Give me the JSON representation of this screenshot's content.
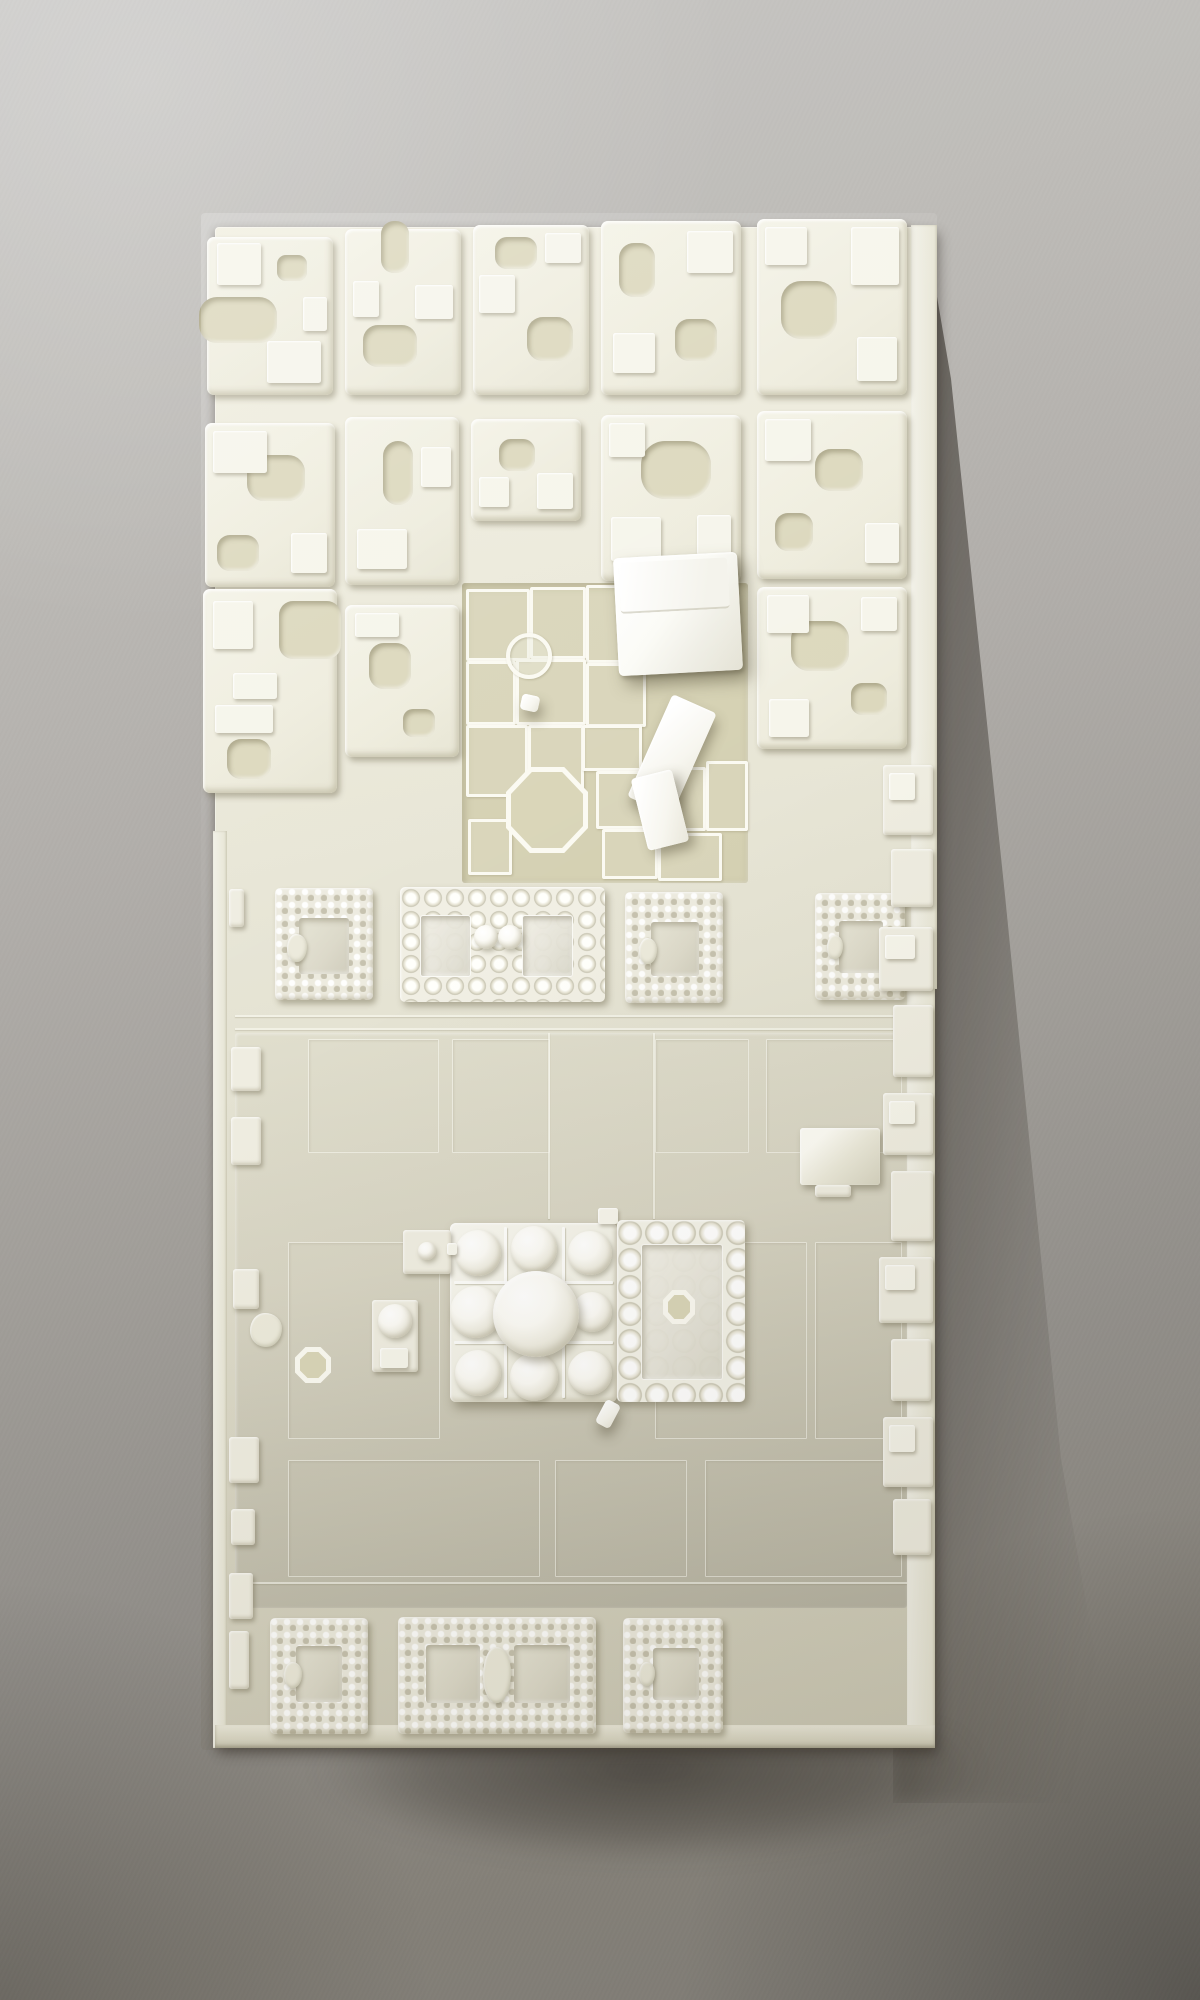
{
  "image_type": "photograph",
  "subject": "White 3D-printed architectural scale model of a historic city district — gridded housing blocks, an excavated ruin field with thin walls, beaded courtyard enclosures, and a central multi-domed mosque complex on a large plaza — photographed on gray paper with a cast shadow to the lower right",
  "palette": {
    "paper_light": "#cbcac8",
    "paper_mid": "#a19e99",
    "paper_dark": "#7d7a74",
    "model_base_light": "#f1efe1",
    "model_base_dark": "#ccc9b6",
    "block_top": "#f4f3e7",
    "block_recess": "#dcd8bd",
    "excavation_floor": "#d5d1b3",
    "plaza_light": "#e0decd",
    "plaza_dark": "#b7b4a4",
    "gloss_white": "#ffffff",
    "dome_white": "#fcfbf6",
    "cast_shadow": "#2a251e"
  },
  "model": {
    "x": 215,
    "y": 227,
    "w": 720,
    "h": 1521
  },
  "city_blocks": [
    {
      "x": -8,
      "y": 10,
      "w": 126,
      "h": 158,
      "cuts": [
        {
          "x": -8,
          "y": 60,
          "w": 78,
          "h": 46,
          "r": 18
        },
        {
          "x": 70,
          "y": 18,
          "w": 30,
          "h": 26,
          "r": 9
        }
      ],
      "tops": [
        {
          "x": 10,
          "y": 6,
          "w": 44,
          "h": 42
        },
        {
          "x": 60,
          "y": 104,
          "w": 54,
          "h": 42
        },
        {
          "x": 96,
          "y": 60,
          "w": 24,
          "h": 34
        }
      ]
    },
    {
      "x": 130,
      "y": 2,
      "w": 116,
      "h": 166,
      "cuts": [
        {
          "x": 36,
          "y": -8,
          "w": 28,
          "h": 52,
          "r": 13
        },
        {
          "x": 18,
          "y": 96,
          "w": 54,
          "h": 42,
          "r": 15
        }
      ],
      "tops": [
        {
          "x": 70,
          "y": 56,
          "w": 38,
          "h": 34
        },
        {
          "x": 8,
          "y": 52,
          "w": 26,
          "h": 36
        }
      ]
    },
    {
      "x": 258,
      "y": -2,
      "w": 116,
      "h": 170,
      "cuts": [
        {
          "x": 22,
          "y": 12,
          "w": 42,
          "h": 32,
          "r": 12
        },
        {
          "x": 54,
          "y": 92,
          "w": 46,
          "h": 44,
          "r": 16
        }
      ],
      "tops": [
        {
          "x": 6,
          "y": 50,
          "w": 36,
          "h": 38
        },
        {
          "x": 72,
          "y": 8,
          "w": 36,
          "h": 30
        }
      ]
    },
    {
      "x": 386,
      "y": -6,
      "w": 140,
      "h": 174,
      "cuts": [
        {
          "x": 18,
          "y": 22,
          "w": 36,
          "h": 54,
          "r": 15
        },
        {
          "x": 74,
          "y": 98,
          "w": 42,
          "h": 42,
          "r": 14
        }
      ],
      "tops": [
        {
          "x": 86,
          "y": 10,
          "w": 46,
          "h": 42
        },
        {
          "x": 12,
          "y": 112,
          "w": 42,
          "h": 40
        }
      ]
    },
    {
      "x": 542,
      "y": -8,
      "w": 150,
      "h": 176,
      "cuts": [
        {
          "x": 24,
          "y": 62,
          "w": 56,
          "h": 58,
          "r": 20
        }
      ],
      "tops": [
        {
          "x": 94,
          "y": 8,
          "w": 48,
          "h": 58
        },
        {
          "x": 8,
          "y": 8,
          "w": 42,
          "h": 38
        },
        {
          "x": 100,
          "y": 118,
          "w": 40,
          "h": 44
        }
      ]
    },
    {
      "x": -10,
      "y": 196,
      "w": 130,
      "h": 164,
      "cuts": [
        {
          "x": 42,
          "y": 32,
          "w": 58,
          "h": 46,
          "r": 17
        },
        {
          "x": 12,
          "y": 112,
          "w": 42,
          "h": 36,
          "r": 13
        }
      ],
      "tops": [
        {
          "x": 8,
          "y": 8,
          "w": 54,
          "h": 42
        },
        {
          "x": 86,
          "y": 110,
          "w": 36,
          "h": 40
        }
      ]
    },
    {
      "x": 130,
      "y": 190,
      "w": 114,
      "h": 168,
      "cuts": [
        {
          "x": 38,
          "y": 24,
          "w": 30,
          "h": 64,
          "r": 15
        }
      ],
      "tops": [
        {
          "x": 12,
          "y": 112,
          "w": 50,
          "h": 40
        },
        {
          "x": 76,
          "y": 30,
          "w": 30,
          "h": 40
        }
      ]
    },
    {
      "x": 256,
      "y": 192,
      "w": 110,
      "h": 102,
      "cuts": [
        {
          "x": 28,
          "y": 20,
          "w": 36,
          "h": 32,
          "r": 12
        }
      ],
      "tops": [
        {
          "x": 66,
          "y": 54,
          "w": 36,
          "h": 36
        },
        {
          "x": 8,
          "y": 58,
          "w": 30,
          "h": 30
        }
      ]
    },
    {
      "x": 386,
      "y": 188,
      "w": 140,
      "h": 166,
      "cuts": [
        {
          "x": 40,
          "y": 26,
          "w": 70,
          "h": 58,
          "r": 24
        }
      ],
      "tops": [
        {
          "x": 10,
          "y": 102,
          "w": 50,
          "h": 44
        },
        {
          "x": 96,
          "y": 100,
          "w": 34,
          "h": 40
        },
        {
          "x": 8,
          "y": 8,
          "w": 36,
          "h": 34
        }
      ]
    },
    {
      "x": 542,
      "y": 184,
      "w": 150,
      "h": 168,
      "cuts": [
        {
          "x": 58,
          "y": 38,
          "w": 48,
          "h": 42,
          "r": 16
        },
        {
          "x": 18,
          "y": 102,
          "w": 38,
          "h": 38,
          "r": 13
        }
      ],
      "tops": [
        {
          "x": 8,
          "y": 8,
          "w": 46,
          "h": 42
        },
        {
          "x": 108,
          "y": 112,
          "w": 34,
          "h": 40
        }
      ]
    },
    {
      "x": -12,
      "y": 362,
      "w": 134,
      "h": 204,
      "cuts": [
        {
          "x": 76,
          "y": 12,
          "w": 62,
          "h": 58,
          "r": 14
        },
        {
          "x": 24,
          "y": 150,
          "w": 44,
          "h": 40,
          "r": 14
        }
      ],
      "tops": [
        {
          "x": 12,
          "y": 116,
          "w": 58,
          "h": 28
        },
        {
          "x": 30,
          "y": 84,
          "w": 44,
          "h": 26
        },
        {
          "x": 10,
          "y": 12,
          "w": 40,
          "h": 48
        }
      ]
    },
    {
      "x": 130,
      "y": 378,
      "w": 114,
      "h": 152,
      "cuts": [
        {
          "x": 24,
          "y": 38,
          "w": 42,
          "h": 46,
          "r": 15
        },
        {
          "x": 58,
          "y": 104,
          "w": 32,
          "h": 28,
          "r": 10
        }
      ],
      "tops": [
        {
          "x": 10,
          "y": 8,
          "w": 44,
          "h": 24
        }
      ]
    },
    {
      "x": 542,
      "y": 360,
      "w": 150,
      "h": 162,
      "cuts": [
        {
          "x": 34,
          "y": 34,
          "w": 58,
          "h": 50,
          "r": 18
        },
        {
          "x": 94,
          "y": 96,
          "w": 36,
          "h": 32,
          "r": 11
        }
      ],
      "tops": [
        {
          "x": 10,
          "y": 8,
          "w": 42,
          "h": 38
        },
        {
          "x": 104,
          "y": 10,
          "w": 36,
          "h": 34
        },
        {
          "x": 12,
          "y": 112,
          "w": 40,
          "h": 38
        }
      ]
    }
  ],
  "excavation": {
    "x": 247,
    "y": 356,
    "w": 286,
    "h": 300,
    "cells": [
      {
        "x": 4,
        "y": 6,
        "w": 58,
        "h": 66
      },
      {
        "x": 68,
        "y": 4,
        "w": 50,
        "h": 66
      },
      {
        "x": 124,
        "y": 2,
        "w": 56,
        "h": 72
      },
      {
        "x": 4,
        "y": 78,
        "w": 44,
        "h": 58
      },
      {
        "x": 54,
        "y": 76,
        "w": 64,
        "h": 60
      },
      {
        "x": 124,
        "y": 80,
        "w": 54,
        "h": 58
      },
      {
        "x": 4,
        "y": 142,
        "w": 56,
        "h": 66
      },
      {
        "x": 66,
        "y": 142,
        "w": 50,
        "h": 62
      },
      {
        "x": 120,
        "y": 142,
        "w": 54,
        "h": 40
      },
      {
        "x": 134,
        "y": 188,
        "w": 46,
        "h": 52
      },
      {
        "x": 186,
        "y": 184,
        "w": 52,
        "h": 58
      },
      {
        "x": 244,
        "y": 178,
        "w": 36,
        "h": 64
      },
      {
        "x": 6,
        "y": 236,
        "w": 38,
        "h": 50
      },
      {
        "x": 140,
        "y": 246,
        "w": 50,
        "h": 44
      },
      {
        "x": 196,
        "y": 250,
        "w": 58,
        "h": 42
      }
    ],
    "octagon": {
      "x": 44,
      "y": 184,
      "w": 82,
      "h": 86
    },
    "circle": {
      "x": 44,
      "y": 50,
      "w": 38,
      "h": 38
    }
  },
  "white_buildings": {
    "prism": {
      "x": 401,
      "y": 328,
      "w": 124,
      "h": 118,
      "angle": -3
    },
    "slabs": [
      {
        "x": 433,
        "y": 472,
        "w": 48,
        "h": 112,
        "angle": 24
      },
      {
        "x": 424,
        "y": 546,
        "w": 42,
        "h": 74,
        "angle": -14
      },
      {
        "x": 306,
        "y": 468,
        "w": 18,
        "h": 16,
        "angle": 12
      }
    ]
  },
  "beaded_row": [
    {
      "x": 60,
      "y": 661,
      "w": 98,
      "h": 112,
      "pattern": "knurl",
      "courts": [
        {
          "x": 24,
          "y": 30,
          "w": 50,
          "h": 56
        }
      ],
      "blob": {
        "x": 12,
        "y": 46,
        "w": 20,
        "h": 28
      }
    },
    {
      "x": 185,
      "y": 660,
      "w": 205,
      "h": 115,
      "pattern": "bead",
      "courts": [
        {
          "x": 20,
          "y": 28,
          "w": 49,
          "h": 60
        },
        {
          "x": 122,
          "y": 28,
          "w": 49,
          "h": 60
        }
      ],
      "domes": [
        {
          "x": 74,
          "y": 38,
          "d": 24
        },
        {
          "x": 98,
          "y": 38,
          "d": 24
        }
      ]
    },
    {
      "x": 410,
      "y": 665,
      "w": 98,
      "h": 111,
      "pattern": "knurl",
      "courts": [
        {
          "x": 26,
          "y": 30,
          "w": 48,
          "h": 54
        }
      ],
      "blob": {
        "x": 14,
        "y": 46,
        "w": 18,
        "h": 26
      }
    },
    {
      "x": 600,
      "y": 666,
      "w": 90,
      "h": 107,
      "pattern": "knurl",
      "courts": [
        {
          "x": 24,
          "y": 28,
          "w": 44,
          "h": 52
        }
      ],
      "blob": {
        "x": 12,
        "y": 42,
        "w": 16,
        "h": 24
      }
    }
  ],
  "bottom_row": [
    {
      "x": 55,
      "y": 1391,
      "w": 98,
      "h": 116,
      "pattern": "knurl",
      "courts": [
        {
          "x": 26,
          "y": 28,
          "w": 46,
          "h": 56
        }
      ],
      "blob": {
        "x": 14,
        "y": 44,
        "w": 18,
        "h": 26
      }
    },
    {
      "x": 183,
      "y": 1390,
      "w": 198,
      "h": 117,
      "pattern": "knurl",
      "courts": [
        {
          "x": 28,
          "y": 28,
          "w": 54,
          "h": 58
        },
        {
          "x": 116,
          "y": 28,
          "w": 56,
          "h": 58
        }
      ],
      "blob": {
        "x": 85,
        "y": 30,
        "w": 28,
        "h": 56
      }
    },
    {
      "x": 408,
      "y": 1391,
      "w": 100,
      "h": 115,
      "pattern": "knurl",
      "courts": [
        {
          "x": 30,
          "y": 30,
          "w": 46,
          "h": 52
        }
      ],
      "blob": {
        "x": 16,
        "y": 44,
        "w": 16,
        "h": 24
      }
    }
  ],
  "mosque": {
    "block": {
      "x": 235,
      "y": 996,
      "w": 167,
      "h": 179
    },
    "walls": [
      {
        "x": 54,
        "y": 4,
        "w": 3,
        "h": 171
      },
      {
        "x": 112,
        "y": 4,
        "w": 3,
        "h": 171
      },
      {
        "x": 4,
        "y": 58,
        "w": 159,
        "h": 3
      },
      {
        "x": 4,
        "y": 118,
        "w": 159,
        "h": 3
      }
    ],
    "domes": [
      {
        "cx": 28,
        "cy": 30,
        "d": 46
      },
      {
        "cx": 26,
        "cy": 89,
        "d": 52
      },
      {
        "cx": 28,
        "cy": 150,
        "d": 46
      },
      {
        "cx": 84,
        "cy": 26,
        "d": 46
      },
      {
        "cx": 84,
        "cy": 154,
        "d": 48
      },
      {
        "cx": 140,
        "cy": 30,
        "d": 44
      },
      {
        "cx": 142,
        "cy": 89,
        "d": 40
      },
      {
        "cx": 140,
        "cy": 150,
        "d": 44
      }
    ],
    "center_dome": {
      "cx": 86,
      "cy": 91,
      "d": 86
    },
    "pishtaq": {
      "x": 383,
      "y": 981,
      "w": 20,
      "h": 16
    },
    "handle": {
      "x": 385,
      "y": 1174,
      "w": 16,
      "h": 26,
      "angle": 28
    },
    "courtyard": {
      "x": 402,
      "y": 993,
      "w": 128,
      "h": 182,
      "pattern": "bead-big",
      "courts": [
        {
          "x": 24,
          "y": 24,
          "w": 80,
          "h": 134
        }
      ],
      "fountain": {
        "x": 46,
        "y": 70,
        "w": 32,
        "h": 34
      }
    }
  },
  "satellites": {
    "platform": {
      "x": 188,
      "y": 1003,
      "w": 48,
      "h": 44,
      "dome": {
        "x": 15,
        "y": 12,
        "d": 18
      }
    },
    "neck": {
      "x": 232,
      "y": 1016,
      "w": 10,
      "h": 12
    },
    "kiosk": {
      "x": 157,
      "y": 1073,
      "w": 46,
      "h": 72,
      "dome": {
        "x": 6,
        "y": 4,
        "d": 34
      },
      "step": {
        "x": 8,
        "y": 48,
        "w": 28,
        "h": 20
      }
    },
    "pier": {
      "x": 80,
      "y": 1120,
      "w": 36,
      "h": 36
    },
    "rock": {
      "x": 35,
      "y": 1086,
      "w": 32,
      "h": 34
    }
  },
  "pyramid_building": {
    "x": 585,
    "y": 901,
    "w": 80,
    "h": 57,
    "base_tab": {
      "x": 600,
      "y": 958,
      "w": 36,
      "h": 12
    }
  },
  "edge_tabs": [
    {
      "x": 14,
      "y": 662,
      "w": 15,
      "h": 38
    },
    {
      "x": 16,
      "y": 820,
      "w": 30,
      "h": 44
    },
    {
      "x": 16,
      "y": 890,
      "w": 30,
      "h": 48
    },
    {
      "x": 18,
      "y": 1042,
      "w": 26,
      "h": 40
    },
    {
      "x": 14,
      "y": 1210,
      "w": 30,
      "h": 46
    },
    {
      "x": 16,
      "y": 1282,
      "w": 24,
      "h": 36
    },
    {
      "x": 14,
      "y": 1346,
      "w": 24,
      "h": 46
    },
    {
      "x": 14,
      "y": 1404,
      "w": 20,
      "h": 58
    }
  ],
  "edge_fragments": [
    {
      "x": 668,
      "y": 538,
      "w": 50,
      "h": 70
    },
    {
      "x": 676,
      "y": 622,
      "w": 42,
      "h": 58
    },
    {
      "x": 664,
      "y": 700,
      "w": 54,
      "h": 64
    },
    {
      "x": 678,
      "y": 778,
      "w": 40,
      "h": 72
    },
    {
      "x": 668,
      "y": 866,
      "w": 50,
      "h": 62
    },
    {
      "x": 676,
      "y": 944,
      "w": 42,
      "h": 70
    },
    {
      "x": 664,
      "y": 1030,
      "w": 54,
      "h": 66
    },
    {
      "x": 676,
      "y": 1112,
      "w": 40,
      "h": 62
    },
    {
      "x": 668,
      "y": 1190,
      "w": 50,
      "h": 70
    },
    {
      "x": 678,
      "y": 1272,
      "w": 38,
      "h": 56
    }
  ],
  "plaza": {
    "rect": {
      "x": 20,
      "y": 806,
      "w": 672,
      "h": 575
    },
    "panels": [
      {
        "x": 93,
        "y": 812,
        "w": 129,
        "h": 112
      },
      {
        "x": 237,
        "y": 812,
        "w": 96,
        "h": 112
      },
      {
        "x": 440,
        "y": 812,
        "w": 92,
        "h": 112
      },
      {
        "x": 551,
        "y": 812,
        "w": 134,
        "h": 112
      },
      {
        "x": 73,
        "y": 1015,
        "w": 150,
        "h": 195
      },
      {
        "x": 440,
        "y": 1015,
        "w": 150,
        "h": 195
      },
      {
        "x": 600,
        "y": 1015,
        "w": 85,
        "h": 195
      },
      {
        "x": 73,
        "y": 1233,
        "w": 250,
        "h": 115
      },
      {
        "x": 340,
        "y": 1233,
        "w": 130,
        "h": 115
      },
      {
        "x": 490,
        "y": 1233,
        "w": 195,
        "h": 115
      }
    ],
    "lines": [
      {
        "x": 20,
        "y": 788,
        "w": 672,
        "h": 2
      },
      {
        "x": 20,
        "y": 801,
        "w": 672,
        "h": 2
      },
      {
        "x": 20,
        "y": 1355,
        "w": 672,
        "h": 2
      },
      {
        "x": 333,
        "y": 806,
        "w": 2,
        "h": 186
      },
      {
        "x": 438,
        "y": 806,
        "w": 2,
        "h": 186
      }
    ]
  },
  "base_bevels": {
    "left": {
      "x": -2,
      "y": 604,
      "w": 14,
      "h": 917
    },
    "right_top": {
      "x": 696,
      "y": -2,
      "w": 26,
      "h": 764
    },
    "right_bottom": {
      "x": 692,
      "y": 762,
      "w": 28,
      "h": 740
    },
    "bottom": {
      "x": 0,
      "y": 1498,
      "w": 720,
      "h": 23
    }
  }
}
